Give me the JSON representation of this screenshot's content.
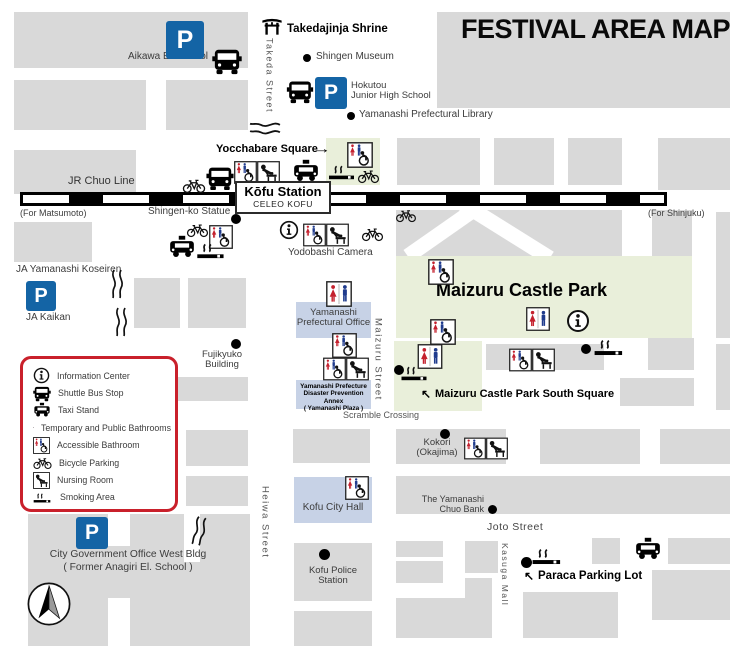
{
  "title": "FESTIVAL AREA MAP",
  "labels": {
    "p": "P",
    "aikawa": "Aikawa El. School",
    "takedajinja": "Takedajinja Shrine",
    "takeda_street": "Takeda Street",
    "shingen_museum": "Shingen Museum",
    "hokutou_l1": "Hokutou",
    "hokutou_l2": "Junior High School",
    "library": "Yamanashi Prefectural Library",
    "yocchabare": "Yocchabare Square",
    "jr_chuo": "JR Chuo Line",
    "for_matsumoto": "(For Matsumoto)",
    "for_shinjuku": "(For Shinjuku)",
    "station_name": "Kōfu Station",
    "station_sub": "CELEO KOFU",
    "shingen_statue": "Shingen-ko Statue",
    "yodobashi": "Yodobashi Camera",
    "ja_koseiren": "JA Yamanashi Koseiren",
    "ja_kaikan": "JA Kaikan",
    "maizuru_park": "Maizuru Castle Park",
    "pref_office_l1": "Yamanashi",
    "pref_office_l2": "Prefectural Office",
    "fujikyuko_l1": "Fujikyuko",
    "fujikyuko_l2": "Building",
    "annex_l1": "Yamanashi Prefecture",
    "annex_l2": "Disaster Prevention Annex",
    "annex_l3": "( Yamanashi Plaza )",
    "maizuru_street": "Maizuru Street",
    "scramble": "Scramble Crossing",
    "south_square": "Maizuru Castle Park South Square",
    "kokori_l1": "Kokori",
    "kokori_l2": "(Okajima)",
    "city_hall": "Kofu City Hall",
    "chuo_bank_l1": "The Yamanashi",
    "chuo_bank_l2": "Chuo Bank",
    "joto_street": "Joto Street",
    "heiwa_street": "Heiwa Street",
    "kasuga_mall": "Kasuga Mall",
    "police": "Kofu Police Station",
    "paraca": "Paraca Parking Lot",
    "city_gov_l1": "City Government Office West Bldg",
    "city_gov_l2": "( Former Anagiri El. School )",
    "compass_n": "N",
    "arrow_right": "→",
    "arrow_upleft": "↖"
  },
  "legend": {
    "items": [
      {
        "icon": "info-icon",
        "label": "Information Center"
      },
      {
        "icon": "shuttle-bus-icon",
        "label": "Shuttle Bus Stop"
      },
      {
        "icon": "taxi-icon",
        "label": "Taxi Stand"
      },
      {
        "icon": "bathroom-icon",
        "label": "Temporary and Public Bathrooms"
      },
      {
        "icon": "accessible-bathroom-icon",
        "label": "Accessible Bathroom"
      },
      {
        "icon": "bicycle-icon",
        "label": "Bicycle Parking"
      },
      {
        "icon": "nursing-room-icon",
        "label": "Nursing Room"
      },
      {
        "icon": "smoking-area-icon",
        "label": "Smoking Area"
      }
    ]
  },
  "colors": {
    "block_gray": "#d9d9d9",
    "park_green": "#e9efda",
    "building_blue": "#c7d2e6",
    "parking_blue": "#1464a5",
    "legend_red": "#c9202b",
    "female_red": "#c4212e",
    "male_blue": "#1f3b8d"
  }
}
